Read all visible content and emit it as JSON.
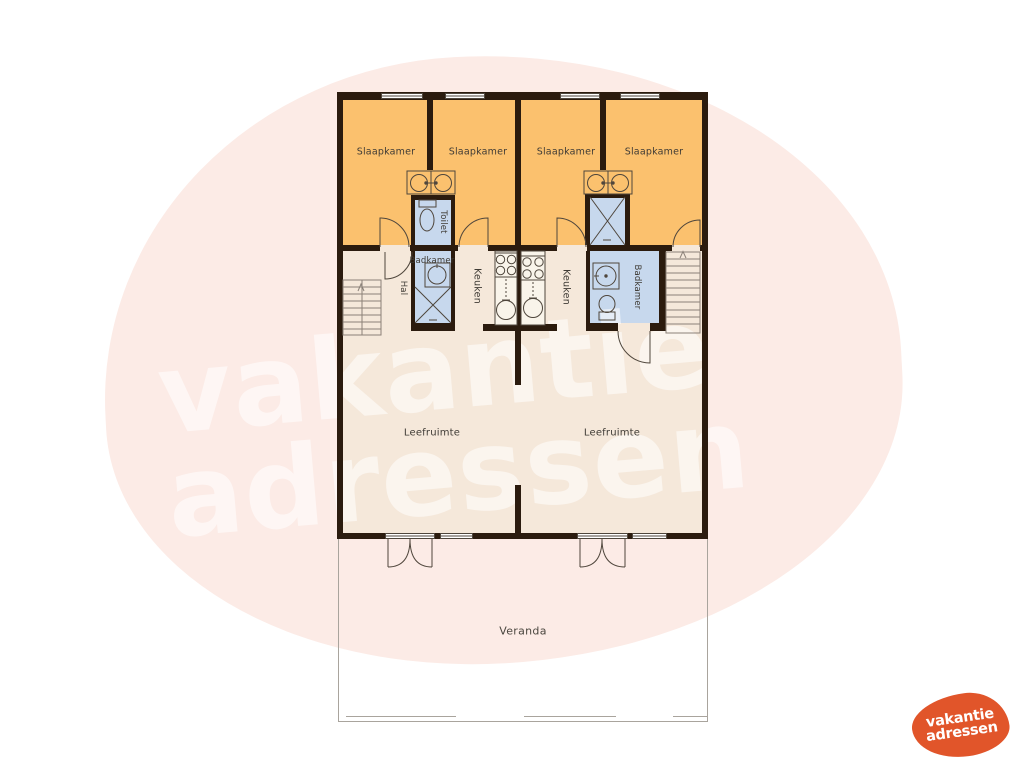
{
  "watermark": {
    "line1": "vakantie",
    "line2": "adressen"
  },
  "logo": {
    "line1": "vakantie",
    "line2": "adressen"
  },
  "plan": {
    "bedrooms": [
      "Slaapkamer",
      "Slaapkamer",
      "Slaapkamer",
      "Slaapkamer"
    ],
    "toilet": "Toilet",
    "badkamer_left": "Badkamer",
    "badkamer_right": "Badkamer",
    "hal": "Hal",
    "keuken_left": "Keuken",
    "keuken_right": "Keuken",
    "leefruimte_left": "Leefruimte",
    "leefruimte_right": "Leefruimte",
    "veranda": "Veranda"
  },
  "colors": {
    "bedroom_fill": "#fbc16e",
    "floor_fill": "#f5e8da",
    "wet_room_fill": "#c7d8ed",
    "wall": "#2b1b0e",
    "watermark_blob": "#fcebe6",
    "logo_orange": "#e1552a"
  }
}
